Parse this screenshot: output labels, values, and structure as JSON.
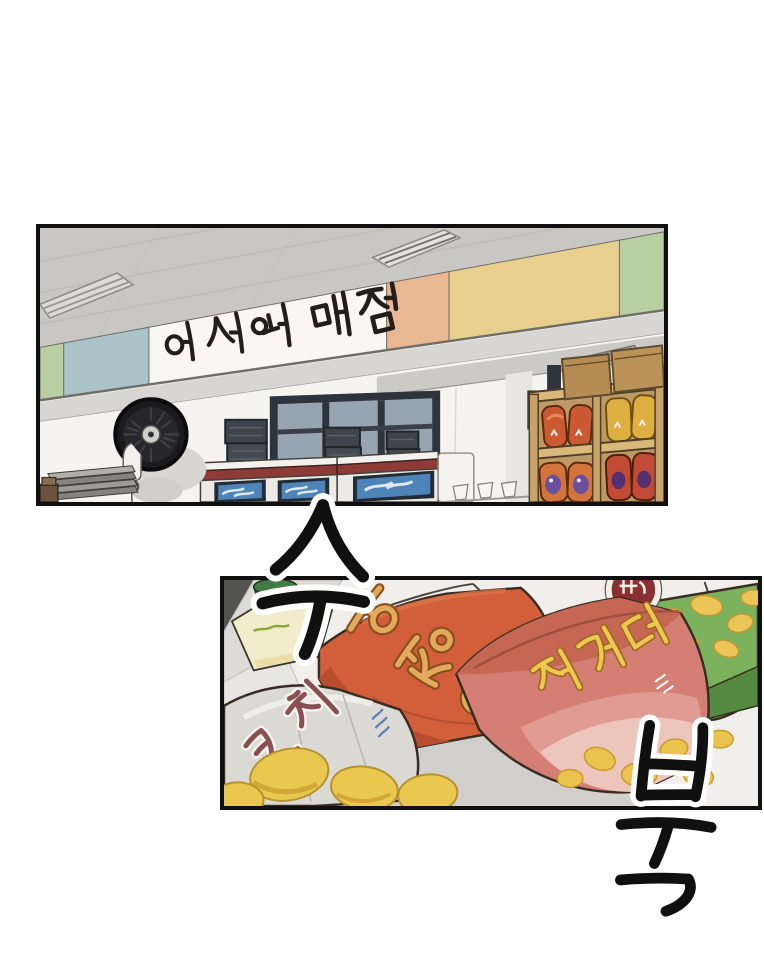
{
  "page": {
    "kind": "webtoon comic page",
    "background_color": "#ffffff",
    "panel_border_color": "#101010"
  },
  "panel_top": {
    "scene": "school snack shop interior",
    "sign": {
      "text": "어서와 매점",
      "board_color": "#f8f7f3",
      "text_color": "#221f1b"
    },
    "wall_band_colors": [
      "#b8cfa2",
      "#a9c3c9",
      "#f8f7f3",
      "#e9b791",
      "#e9cf8d",
      "#b8cfa2"
    ],
    "objects": [
      "ceiling-lights",
      "wall-fan",
      "window",
      "stacked-crates",
      "ice-cream-freezers",
      "paper-cups",
      "snack-shelf",
      "cardboard-boxes",
      "tray-stack"
    ]
  },
  "panel_bottom": {
    "scene": "snack bags close-up on shop shelf",
    "bags": [
      {
        "name": "orange-snack-bag",
        "label": "오징어",
        "color": "#d25f3a",
        "label_color": "#e2aa5c"
      },
      {
        "name": "pink-snack-bag",
        "label": "자가다",
        "color": "#d47e74",
        "label_color": "#ecc853"
      },
      {
        "name": "green-snack-bag",
        "label": "",
        "color": "#7cb25e"
      },
      {
        "name": "silver-snack-bag",
        "label": "코치",
        "color": "#dad9d4",
        "label_color": "#8a4f50"
      },
      {
        "name": "cream-snack-bag",
        "label": "",
        "color": "#f2eccd"
      }
    ]
  },
  "sfx": {
    "top": {
      "text": "수",
      "style": "black brush strokes with white outline"
    },
    "bottom": {
      "text": "북",
      "style": "black brush strokes with white outline"
    }
  }
}
